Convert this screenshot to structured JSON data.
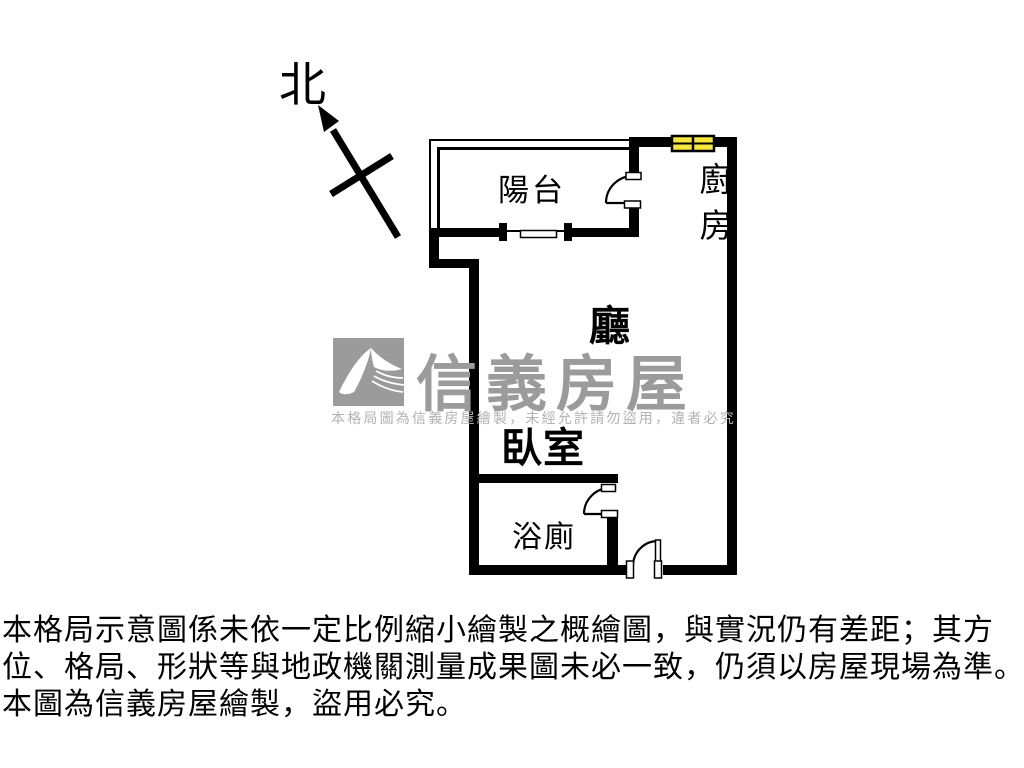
{
  "north": {
    "label": "北"
  },
  "plan": {
    "labels": {
      "balcony": "陽台",
      "kitchen": "廚房",
      "living": "廳",
      "bedroom": "臥室",
      "bathroom": "浴廁"
    }
  },
  "watermark": {
    "brand": "信義房屋",
    "notice": "本格局圖為信義房屋繪製，未經允許請勿盜用，違者必究"
  },
  "disclaimer": {
    "line1": "本格局示意圖係未依一定比例縮小繪製之概繪圖，與實況仍有差距；其方",
    "line2": "位、格局、形狀等與地政機關測量成果圖未必一致，仍須以房屋現場為準。",
    "line3": "本圖為信義房屋繪製，盜用必究。"
  },
  "colors": {
    "wall": "#000000",
    "window_fill": "#F2E73A",
    "watermark_gray": "#9B9B9B"
  }
}
